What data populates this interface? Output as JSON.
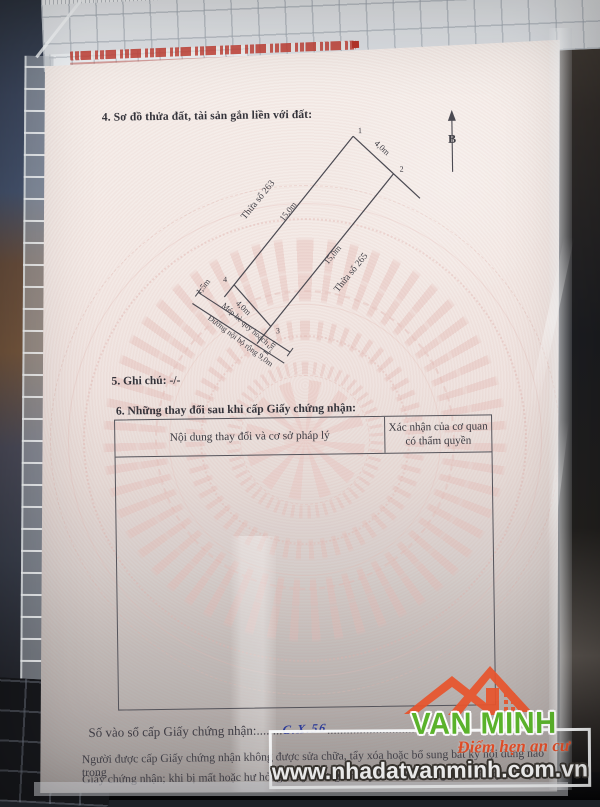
{
  "scene": {
    "brand": {
      "name": "VAN MINH",
      "tagline": "Điểm hẹn an cư",
      "website": "www.nhadatvanminh.com.vn",
      "green": "#5cb52c",
      "orange": "#e8542c"
    }
  },
  "document": {
    "section4_heading": "4. Sơ đồ thửa đất, tài sản gắn liền với đất:",
    "diagram": {
      "north": "B",
      "points": [
        "1",
        "2",
        "3",
        "4"
      ],
      "top_edge": "4,0m",
      "left_edge": "15,0m",
      "right_edge": "15,0m",
      "bottom_edge": "4,0m",
      "left_parcel": "Thửa số 263",
      "right_parcel": "Thửa số 265",
      "left_setback": "1,5m",
      "right_setback": "1,5m",
      "sidewalk": "Mép hè quy hoạch",
      "road": "Đường nội bộ rộng 9,0m"
    },
    "section5_heading": "5. Ghi chú: -/-",
    "section6_heading": "6. Những thay đổi sau khi cấp Giấy chứng nhận:",
    "table": {
      "col1_header": "Nội dung thay đổi và cơ sở pháp lý",
      "col2_header_line1": "Xác nhận của cơ quan",
      "col2_header_line2": "có thẩm quyền"
    },
    "footer": {
      "register_label": "Số vào sổ cấp Giấy chứng nhận:",
      "dots_before": "........",
      "register_value": "C.X.56",
      "dots_after": "...........................",
      "note_line1": "Người được cấp Giấy chứng nhận không được sửa chữa, tẩy xóa hoặc bổ sung bất kỳ nội dung nào trong",
      "note_line2": "Giấy chứng nhận; khi bị mất hoặc hư hỏng Giấy chứng nhận phải khai báo ngay với cơ quan cấp Giấy"
    }
  }
}
